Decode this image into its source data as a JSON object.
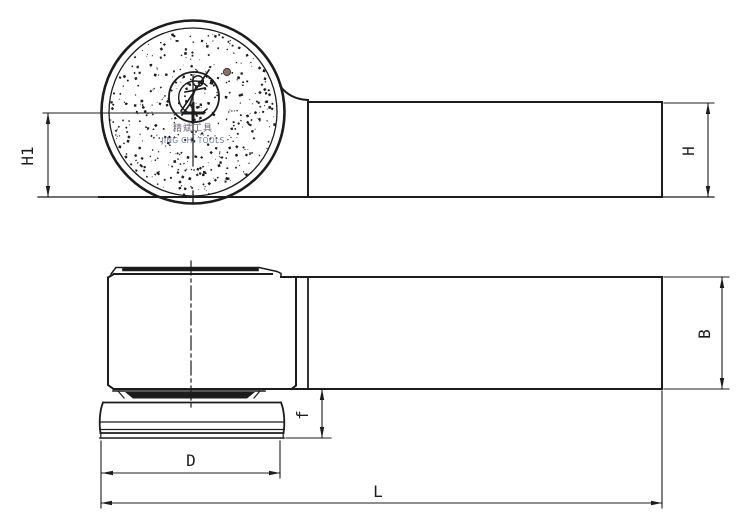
{
  "page": {
    "background": "#ffffff"
  },
  "drawing": {
    "line_color": "#1c1c1c",
    "accent_dot_color": "#8a7268",
    "brand_cn_color": "#6e6278",
    "brand_en_color": "#6b7aa0"
  },
  "brand": {
    "name_cn": "精斌工具",
    "name_en": "JING CHI TOOLS"
  },
  "dimensions": {
    "h1": "H1",
    "h": "H",
    "b": "B",
    "f": "f",
    "d": "D",
    "l": "L"
  }
}
